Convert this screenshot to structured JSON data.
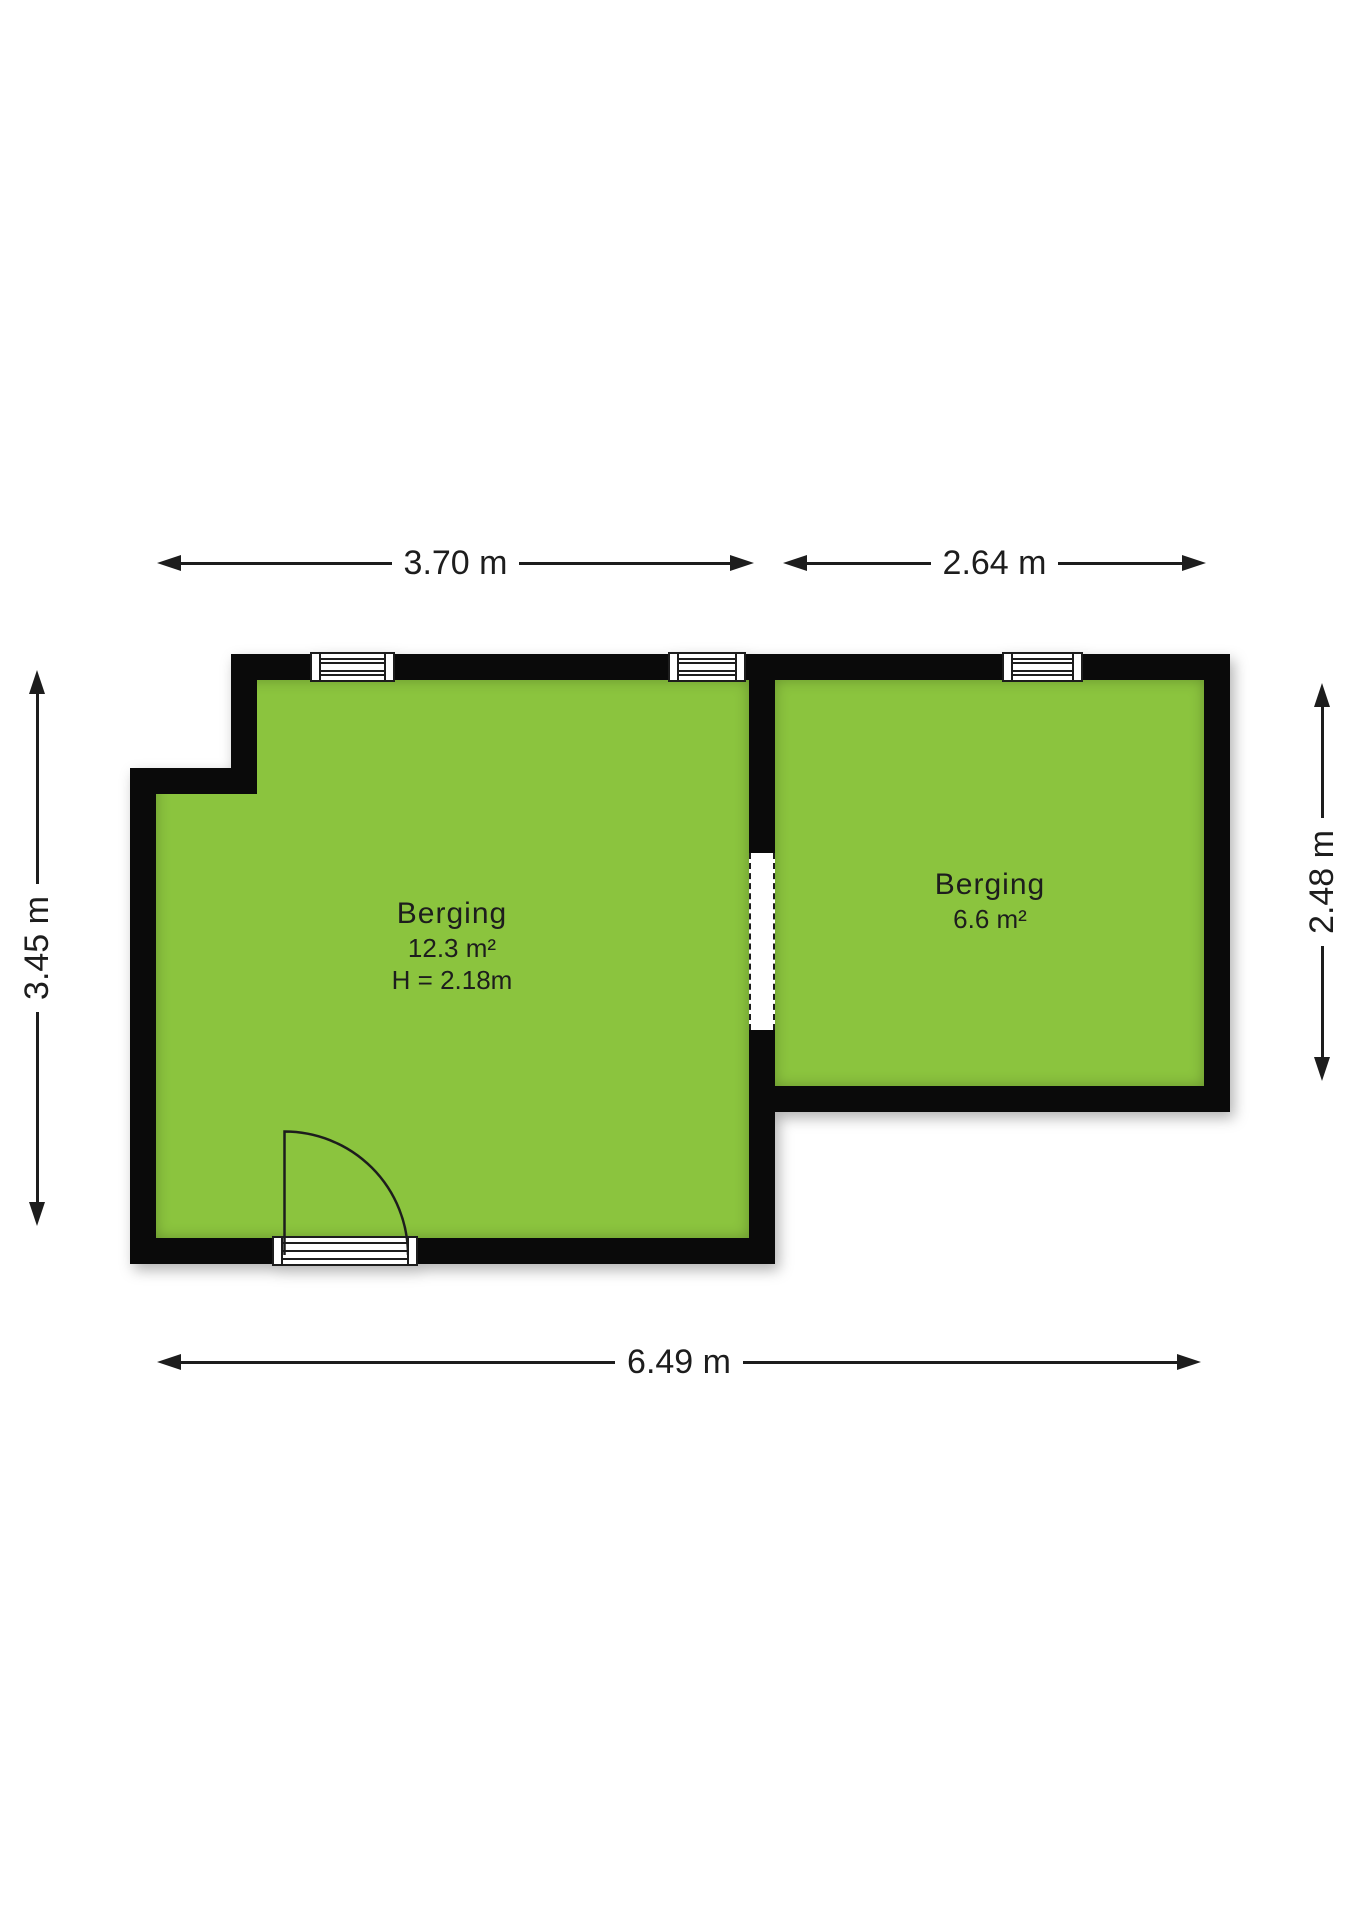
{
  "plan": {
    "rooms": [
      {
        "name": "Berging",
        "area": "12.3 m²",
        "ceiling": "H = 2.18m"
      },
      {
        "name": "Berging",
        "area": "6.6 m²"
      }
    ],
    "dimensions": {
      "top_left": "3.70 m",
      "top_right": "2.64 m",
      "left": "3.45 m",
      "right": "2.48 m",
      "bottom": "6.49 m"
    }
  },
  "colors": {
    "floor": "#8BC43E",
    "wall": "#0A0A0A",
    "line": "#1D1D1D",
    "text": "#1D1D1D"
  }
}
